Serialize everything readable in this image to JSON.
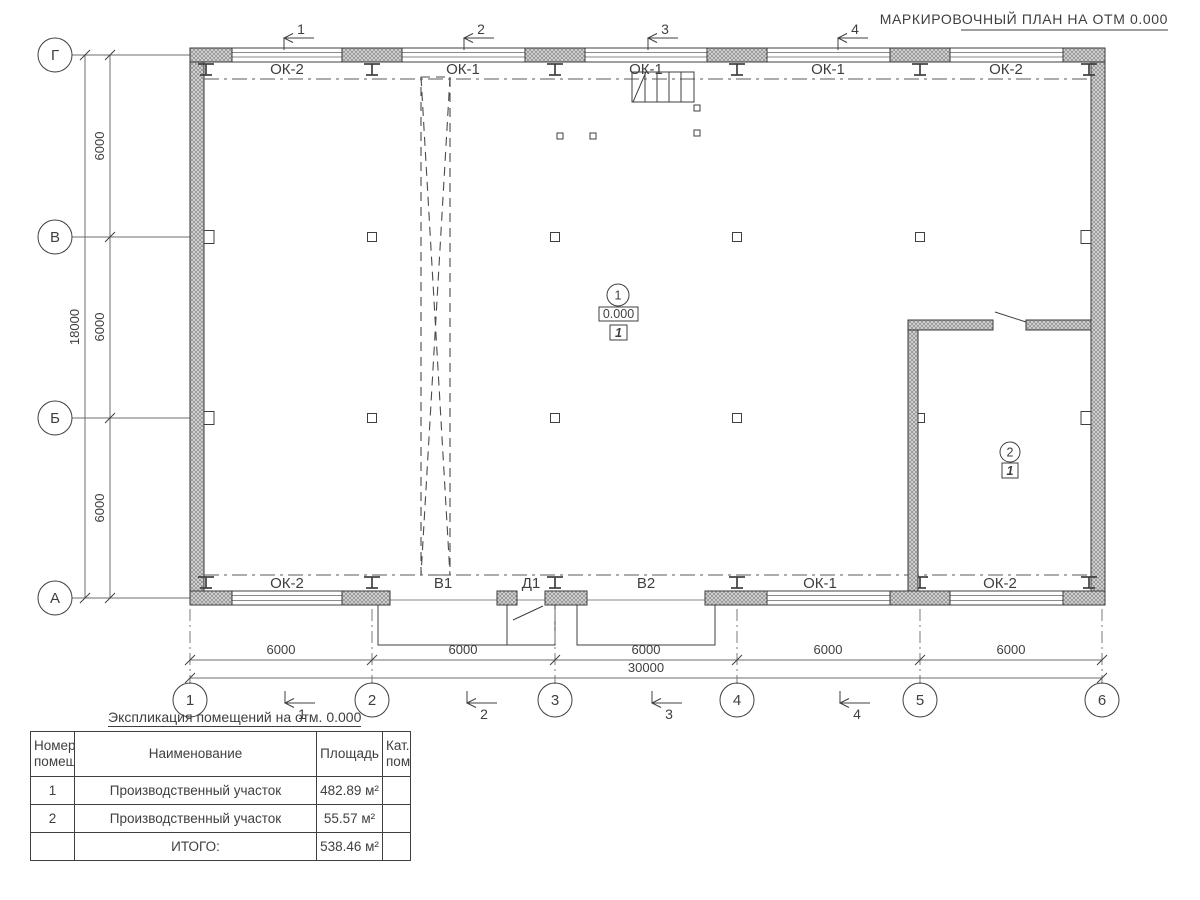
{
  "title": "МАРКИРОВОЧНЫЙ ПЛАН НА ОТМ 0.000",
  "axes": {
    "rows": [
      "Г",
      "В",
      "Б",
      "А"
    ],
    "cols": [
      "1",
      "2",
      "3",
      "4",
      "5",
      "6"
    ]
  },
  "sections": {
    "top": [
      "1",
      "2",
      "3",
      "4"
    ],
    "bottom": [
      "1",
      "2",
      "3",
      "4"
    ]
  },
  "openings": {
    "top": [
      "ОК-2",
      "ОК-1",
      "ОК-1",
      "ОК-1",
      "ОК-2"
    ],
    "bottom": [
      "ОК-2",
      "В1",
      "Д1",
      "В2",
      "ОК-1",
      "ОК-2"
    ]
  },
  "dimensions": {
    "bottom_segments": [
      "6000",
      "6000",
      "6000",
      "6000",
      "6000"
    ],
    "bottom_total": "30000",
    "left_segments": [
      "6000",
      "6000",
      "6000"
    ],
    "left_total": "18000"
  },
  "rooms": {
    "room1": {
      "number": "1",
      "elevation": "0.000",
      "zone": "1"
    },
    "room2": {
      "number": "2",
      "zone": "1"
    }
  },
  "legend_table": {
    "title": "Экспликация помещений на отм. 0.000",
    "headers": [
      "Номер помещ.",
      "Наименование",
      "Площадь",
      "Кат. пом."
    ],
    "rows": [
      {
        "number": "1",
        "name": "Производственный участок",
        "area": "482.89 м²",
        "cat": ""
      },
      {
        "number": "2",
        "name": "Производственный участок",
        "area": "55.57 м²",
        "cat": ""
      }
    ],
    "total_label": "ИТОГО:",
    "total_area": "538.46 м²"
  },
  "colors": {
    "line": "#3f3f3f",
    "hatch": "#bdbdbd",
    "background": "#ffffff"
  }
}
